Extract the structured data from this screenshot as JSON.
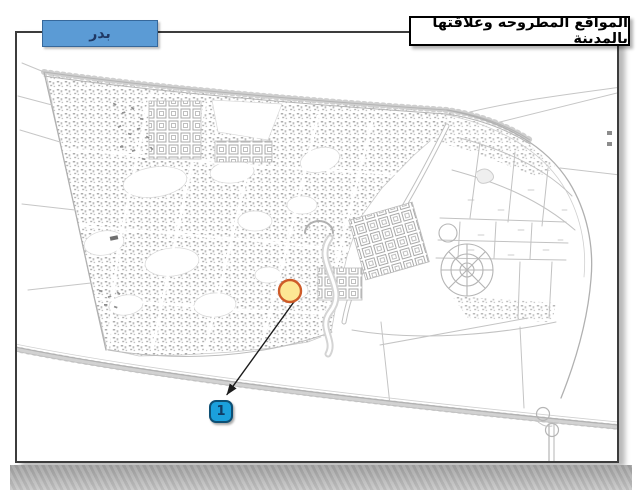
{
  "header": {
    "region_label": "بدر",
    "title": "المواقع المطروحه وعلاقتها بالمدينة"
  },
  "annotation": {
    "site_number": "1",
    "marker_fill": "#FDE794",
    "marker_border": "#CE5B28",
    "badge_fill": "#1BA0DC",
    "badge_border": "#0D4F74",
    "badge_text_color": "#103C64",
    "arrow_color": "#1C1C1C"
  },
  "colors": {
    "region_box_fill": "#5B9BD5",
    "region_box_border": "#36689B",
    "region_text": "#1F3864",
    "title_box_border": "#000000",
    "frame_border": "#3C3C3C",
    "map_linework": "#B5B5B5",
    "scan_band": "#ADADAD",
    "background": "#FFFFFF"
  }
}
